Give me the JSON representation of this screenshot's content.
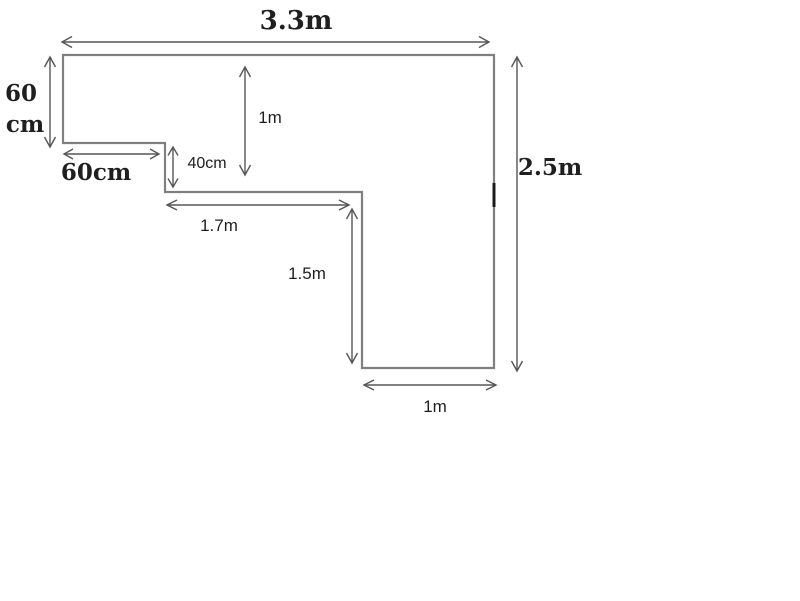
{
  "figure": {
    "kind": "dimensioned-floor-plan",
    "dimensions": {
      "top_width": "3.3m",
      "left_height_line1": "60",
      "left_height_line2": "cm",
      "notch_width": "60cm",
      "notch_height": "40cm",
      "upper_inner_height": "1m",
      "middle_width": "1.7m",
      "lower_inner_height": "1.5m",
      "right_height": "2.5m",
      "bottom_width": "1m"
    }
  },
  "colors": {
    "background": "#ffffff",
    "outline": "#7f7f7f",
    "arrow": "#565656",
    "artifact": "#1c1c1c",
    "text": "#1f1f1f"
  }
}
